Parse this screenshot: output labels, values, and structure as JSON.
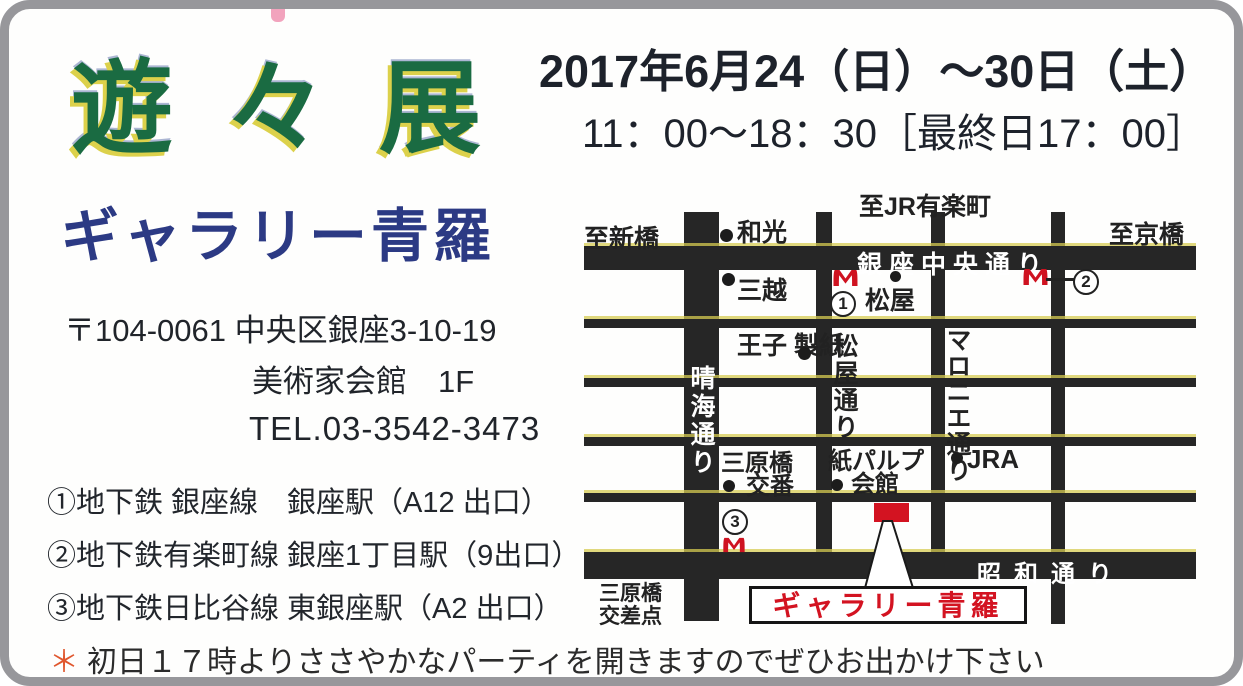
{
  "title": "遊々展",
  "schedule": {
    "dates": "2017年6月24（日）～30日（土）",
    "hours": "11：00～18：30［最終日17：00］"
  },
  "gallery": {
    "name": "ギャラリー青羅",
    "postal_address": "〒104-0061 中央区銀座3-10-19",
    "building": "美術家会館　1F",
    "tel": "TEL.03-3542-3473"
  },
  "access": {
    "stations": [
      "①地下鉄 銀座線　銀座駅（A12 出口）",
      "②地下鉄有楽町線 銀座1丁目駅（9出口）",
      "③地下鉄日比谷線 東銀座駅（A2 出口）"
    ]
  },
  "note": {
    "mark": "＊",
    "text": "初日１７時よりささやかなパーティを開きますのでぜひお出かけ下さい"
  },
  "map": {
    "directions": {
      "top": "至JR有楽町",
      "left": "至新橋",
      "right": "至京橋"
    },
    "streets": {
      "ginza_chuo": "銀座中央通り",
      "showa": "昭和通り",
      "harumi": "晴海通り",
      "matsuya": "松屋通り",
      "maronie": "マロニエ通り"
    },
    "landmarks": {
      "wako": "和光",
      "mitsukoshi": "三越",
      "matsuya_store": "松屋",
      "oji_paper": "王子\n製紙",
      "koban_line1": "三原橋",
      "koban_line2": "交番",
      "pulp_line1": "紙パルプ",
      "pulp_line2": "会館",
      "jra": "JRA"
    },
    "exits": {
      "e1": "1",
      "e2": "2",
      "e3": "3"
    },
    "gallery_label": "ギャラリー青羅",
    "intersection": "三原橋\n交差点"
  },
  "colors": {
    "title_green": "#1a6b42",
    "title_shadow_yellow": "#dcd14b",
    "gallery_navy": "#2c3a84",
    "accent_red": "#d31321",
    "road_black": "#262626"
  }
}
